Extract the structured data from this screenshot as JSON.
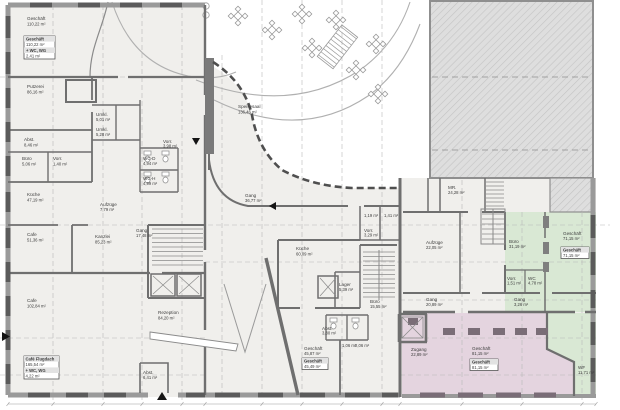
{
  "colors": {
    "floor": "#f0efec",
    "wall": "#6f6f6f",
    "window_block": "#5b5b5b",
    "green": "#d9e8d4",
    "pink": "#e4d4df",
    "pink_wall": "#7a6d77",
    "hatch_bg": "#dedede",
    "grid": "#b8b8b8"
  },
  "rooms": {
    "geschaeft_nw": {
      "name": "Geschäft",
      "area": "110,22 m²"
    },
    "putzerei": {
      "name": "Putzerei",
      "area": "86,16 m²"
    },
    "abst_w": {
      "name": "Abst.",
      "area": "8,46 m²"
    },
    "buero_w": {
      "name": "Büro",
      "area": "5,06 m²"
    },
    "vorr_w": {
      "name": "Vorr.",
      "area": "1,40 m²"
    },
    "umkl_d": {
      "name": "Umkl.",
      "area": "5,01 m²"
    },
    "umkl_h": {
      "name": "Umkl.",
      "area": "5,28 m²"
    },
    "wc_d": {
      "name": "WC-D",
      "area": "4,94 m²"
    },
    "wc_h": {
      "name": "WC-H",
      "area": "4,99 m²"
    },
    "vorr_c": {
      "name": "Vorr.",
      "area": "3,98 m²"
    },
    "kueche_w": {
      "name": "Küche",
      "area": "47,19 m²"
    },
    "cafe_w": {
      "name": "Cafe",
      "area": "51,36 m²"
    },
    "kanzlei": {
      "name": "Kanzlei",
      "area": "85,23 m²"
    },
    "aufzuege_w": {
      "name": "Aufzüge",
      "area": "7,79 m²"
    },
    "gang_w": {
      "name": "Gang",
      "area": "17,48 m²"
    },
    "rezeption": {
      "name": "Rezeption",
      "area": "84,20 m²"
    },
    "abst_s": {
      "name": "Abst.",
      "area": "6,41 m²"
    },
    "cafe_sw": {
      "name": "Cafe",
      "area": "102,84 m²"
    },
    "speisesaal": {
      "name": "Speisesaal",
      "area": "136,46 m²"
    },
    "gang_m": {
      "name": "Gang",
      "area": "36,77 m²"
    },
    "kueche_m": {
      "name": "Küche",
      "area": "60,09 m²"
    },
    "lager": {
      "name": "Lager",
      "area": "5,39 m²"
    },
    "buero_m": {
      "name": "Büro",
      "area": "15,55 m²"
    },
    "vorr_m": {
      "name": "Vorr.",
      "area": "3,29 m²"
    },
    "wc_1": {
      "area": "1,19 m²"
    },
    "wc_2": {
      "area": "1,41 m²"
    },
    "abst_m": {
      "name": "Abst.",
      "area": "3,80 m²"
    },
    "wc_3": {
      "area": "1,06 m²"
    },
    "wc_4": {
      "area": "2,06 m²"
    },
    "geschaeft_m": {
      "name": "Geschäft",
      "area": "45,87 m²"
    },
    "mr": {
      "name": "MR.",
      "area": "24,28 m²"
    },
    "aufzuege_e": {
      "name": "Aufzüge",
      "area": "22,05 m²"
    },
    "buero_e": {
      "name": "Büro",
      "area": "31,19 m²"
    },
    "geschaeft_gr": {
      "name": "Geschäft",
      "area": "71,15 m²"
    },
    "vorr_gr": {
      "name": "Vorr.",
      "area": "1,51 m²"
    },
    "wc_gr": {
      "name": "WC",
      "area": "4,78 m²"
    },
    "gang_e": {
      "name": "Gang",
      "area": "20,89 m²"
    },
    "gang_gr": {
      "name": "Gang",
      "area": "3,26 m²"
    },
    "zugang": {
      "name": "Zugang",
      "area": "22,89 m²"
    },
    "geschaeft_pk": {
      "name": "Geschäft",
      "area": "81,15 m²"
    },
    "wf": {
      "name": "WF",
      "area": "11,71 m²"
    }
  },
  "label_boxes": {
    "nw": {
      "l1": "Geschäft",
      "l2": "110,22 m²",
      "l3": "+ WC, WG",
      "l4": "2,41 m²"
    },
    "sw": {
      "l1": "Café Flugdach",
      "l2": "165,54 m²",
      "l3": "+ WC, WG",
      "l4": "4,22 m²"
    },
    "mid": {
      "l1": "Geschäft",
      "l2": "45,49 m²"
    },
    "green": {
      "l1": "Geschäft",
      "l2": "71,15 m²"
    },
    "pink": {
      "l1": "Geschäft",
      "l2": "81,15 m²"
    }
  }
}
